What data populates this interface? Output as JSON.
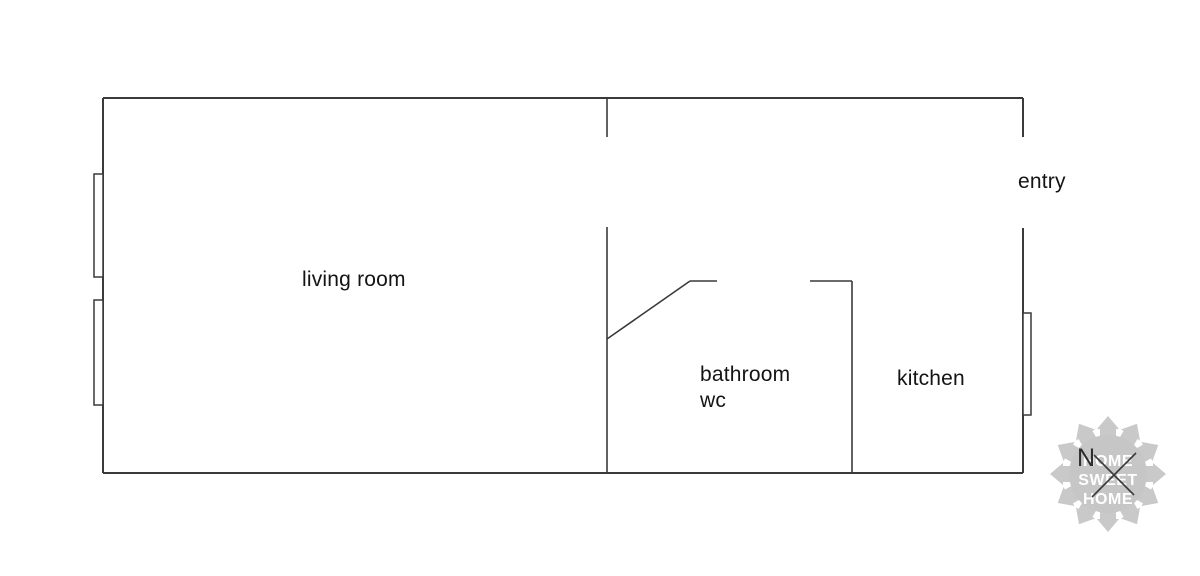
{
  "palette": {
    "background": "#ffffff",
    "wall_color": "#3a3a3a",
    "text_color": "#141414",
    "watermark_gray": "#c7c7c7",
    "watermark_text_color": "#ffffff",
    "compass_color": "#2d2d2d"
  },
  "rooms": {
    "living_room": {
      "label": "living room"
    },
    "bathroom": {
      "label_line1": "bathroom",
      "label_line2": "wc"
    },
    "kitchen": {
      "label": "kitchen"
    },
    "entry": {
      "label": "entry"
    }
  },
  "compass": {
    "north_label": "N"
  },
  "watermark": {
    "line1": "HOME",
    "line2": "SWEET",
    "line3": "HOME"
  }
}
